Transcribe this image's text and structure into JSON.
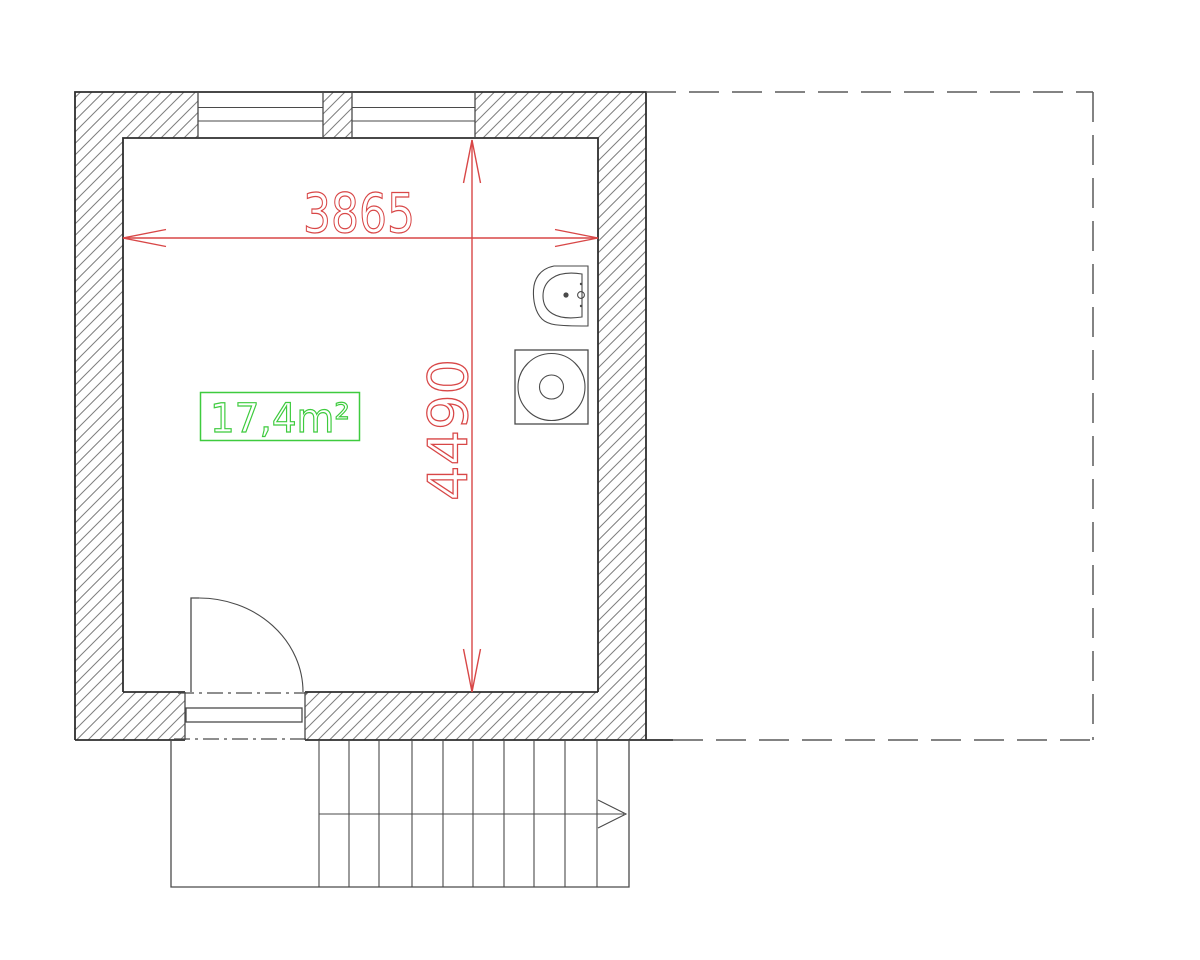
{
  "drawing": {
    "dimensions": {
      "width": "3865",
      "height": "4490"
    },
    "area": "17,4m²",
    "colors": {
      "dimension": "#d84747",
      "area": "#3ecb3e",
      "outline": "#2e2e2e",
      "detail": "#4a4a4a",
      "hatch": "#7e7e7e",
      "dashed": "#5a5a5a",
      "background": "#ffffff"
    },
    "stairs": {
      "treads": 10,
      "direction_arrow": "right"
    },
    "windows_count": 2,
    "fixtures": [
      "washbasin",
      "washing-machine"
    ]
  }
}
